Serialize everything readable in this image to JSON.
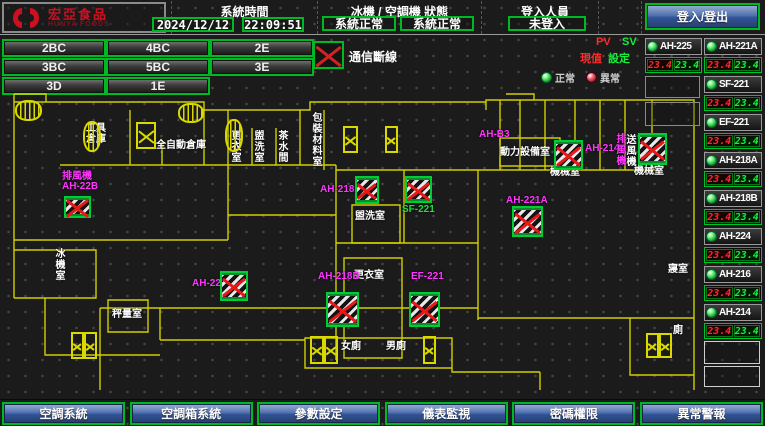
{
  "header": {
    "brand": {
      "name": "宏亞食品",
      "name_en": "HUNYA FOODS"
    },
    "clock": {
      "label": "系統時間",
      "date": "2024/12/12",
      "time": "22:09:51"
    },
    "machine_status": {
      "label": "冰機 / 空調機 狀態",
      "chiller": "系統正常",
      "ac": "系統正常"
    },
    "login": {
      "label": "登入人員",
      "current_user": "未登入",
      "button_label": "登入/登出"
    }
  },
  "floor_nav": {
    "buttons": [
      {
        "label": "2BC",
        "x": 2,
        "y": 39
      },
      {
        "label": "4BC",
        "x": 106,
        "y": 39
      },
      {
        "label": "2E",
        "x": 210,
        "y": 39
      },
      {
        "label": "3BC",
        "x": 2,
        "y": 58
      },
      {
        "label": "5BC",
        "x": 106,
        "y": 58
      },
      {
        "label": "3E",
        "x": 210,
        "y": 58
      },
      {
        "label": "3D",
        "x": 2,
        "y": 77
      },
      {
        "label": "1E",
        "x": 106,
        "y": 77
      }
    ]
  },
  "comm_alert": {
    "label": "通信斷線"
  },
  "status_panel": {
    "pv_label": "PV",
    "sv_label": "SV",
    "pv_caption": "現值",
    "sv_caption": "設定",
    "legend": {
      "normal": "正常",
      "abnormal": "異常"
    },
    "units": [
      {
        "name": "AH-225",
        "pv": "23.4",
        "sv": "23.4"
      },
      {
        "name": "AH-221A",
        "pv": "23.4",
        "sv": "23.4"
      },
      {
        "name": "SF-221",
        "pv": "23.4",
        "sv": "23.4"
      },
      {
        "name": "EF-221",
        "pv": "23.4",
        "sv": "23.4"
      },
      {
        "name": "AH-218A",
        "pv": "23.4",
        "sv": "23.4"
      },
      {
        "name": "AH-218B",
        "pv": "23.4",
        "sv": "23.4"
      },
      {
        "name": "AH-224",
        "pv": "23.4",
        "sv": "23.4"
      },
      {
        "name": "AH-216",
        "pv": "23.4",
        "sv": "23.4"
      },
      {
        "name": "AH-214",
        "pv": "23.4",
        "sv": "23.4"
      }
    ]
  },
  "floor_plan": {
    "rooms": [
      {
        "lines": [
          "工具",
          "倉庫"
        ],
        "x": 86,
        "y": 123
      },
      {
        "lines": [
          "全自動倉庫"
        ],
        "x": 156,
        "y": 140
      },
      {
        "lines": [
          "更衣室"
        ],
        "x": 229,
        "y": 130,
        "vertical": true
      },
      {
        "lines": [
          "盥洗室"
        ],
        "x": 252,
        "y": 130,
        "vertical": true
      },
      {
        "lines": [
          "茶水間"
        ],
        "x": 276,
        "y": 130,
        "vertical": true
      },
      {
        "lines": [
          "包裝材料室"
        ],
        "x": 310,
        "y": 112,
        "vertical": true
      },
      {
        "lines": [
          "動力設備室"
        ],
        "x": 500,
        "y": 147
      },
      {
        "lines": [
          "機械室"
        ],
        "x": 550,
        "y": 167
      },
      {
        "lines": [
          "機械室"
        ],
        "x": 634,
        "y": 166
      },
      {
        "lines": [
          "送風機"
        ],
        "x": 624,
        "y": 134,
        "vertical": true
      },
      {
        "lines": [
          "盥洗室"
        ],
        "x": 355,
        "y": 211
      },
      {
        "lines": [
          "更衣室"
        ],
        "x": 354,
        "y": 270
      },
      {
        "lines": [
          "秤量室"
        ],
        "x": 112,
        "y": 309
      },
      {
        "lines": [
          "冰機室"
        ],
        "x": 53,
        "y": 248,
        "vertical": true
      },
      {
        "lines": [
          "寢室"
        ],
        "x": 668,
        "y": 264
      },
      {
        "lines": [
          "廁"
        ],
        "x": 673,
        "y": 325
      },
      {
        "lines": [
          "女廁"
        ],
        "x": 341,
        "y": 341
      },
      {
        "lines": [
          "男廁"
        ],
        "x": 386,
        "y": 341
      }
    ],
    "devices": [
      {
        "name": "AH-22B",
        "label": {
          "lines": [
            "排風機",
            "AH-22B"
          ],
          "x": 62,
          "y": 172
        },
        "icon": {
          "x": 64,
          "y": 196,
          "w": 27,
          "h": 22
        }
      },
      {
        "name": "AH-B3",
        "label": {
          "lines": [
            "AH-B3"
          ],
          "x": 479,
          "y": 130
        },
        "icon": null
      },
      {
        "name": "AH-214",
        "label": {
          "lines": [
            "AH-214"
          ],
          "x": 585,
          "y": 144
        },
        "icon": {
          "x": 554,
          "y": 140,
          "w": 29,
          "h": 30
        }
      },
      {
        "name": "排風機",
        "label": {
          "lines": [
            "排風機"
          ],
          "x": 614,
          "y": 133,
          "vertical": true
        },
        "icon": {
          "x": 638,
          "y": 133,
          "w": 29,
          "h": 32
        }
      },
      {
        "name": "AH-221A",
        "label": {
          "lines": [
            "AH-221A"
          ],
          "x": 506,
          "y": 196
        },
        "icon": {
          "x": 512,
          "y": 206,
          "w": 31,
          "h": 31
        }
      },
      {
        "name": "AH-218A",
        "label": {
          "lines": [
            "AH-218A"
          ],
          "x": 320,
          "y": 185
        },
        "icon": {
          "x": 355,
          "y": 176,
          "w": 24,
          "h": 28
        }
      },
      {
        "name": "SF-221",
        "label": {
          "lines": [
            "SF-221"
          ],
          "x": 402,
          "y": 205,
          "color": "#22dd44"
        },
        "icon": {
          "x": 405,
          "y": 176,
          "w": 27,
          "h": 27
        }
      },
      {
        "name": "AH-224",
        "label": {
          "lines": [
            "AH-224"
          ],
          "x": 192,
          "y": 279
        },
        "icon": {
          "x": 220,
          "y": 271,
          "w": 28,
          "h": 30
        }
      },
      {
        "name": "AH-218B",
        "label": {
          "lines": [
            "AH-218B"
          ],
          "x": 318,
          "y": 272
        },
        "icon": {
          "x": 326,
          "y": 292,
          "w": 33,
          "h": 35
        }
      },
      {
        "name": "EF-221",
        "label": {
          "lines": [
            "EF-221"
          ],
          "x": 411,
          "y": 272
        },
        "icon": {
          "x": 409,
          "y": 292,
          "w": 31,
          "h": 35
        }
      }
    ],
    "elevator_shafts": [
      [
        136,
        122,
        20,
        27
      ],
      [
        343,
        126,
        15,
        27
      ],
      [
        385,
        126,
        13,
        27
      ],
      [
        71,
        332,
        13,
        27
      ],
      [
        84,
        332,
        13,
        27
      ],
      [
        310,
        336,
        14,
        28
      ],
      [
        324,
        336,
        14,
        28
      ],
      [
        423,
        336,
        13,
        28
      ],
      [
        646,
        333,
        13,
        25
      ],
      [
        659,
        333,
        13,
        25
      ]
    ],
    "stairs": [
      [
        15,
        100,
        27,
        21
      ],
      [
        178,
        103,
        26,
        20
      ],
      [
        83,
        121,
        18,
        31
      ],
      [
        225,
        119,
        18,
        33
      ]
    ]
  },
  "footer": {
    "buttons": [
      "空調系統",
      "空調箱系統",
      "參數設定",
      "儀表監視",
      "密碼權限",
      "異常警報"
    ]
  },
  "colors": {
    "accent_green": "#00b922",
    "alarm_red": "#d42222",
    "magenta": "#ff35ff",
    "wall_yellow": "#d9d900",
    "button_blue": "#31539b"
  }
}
